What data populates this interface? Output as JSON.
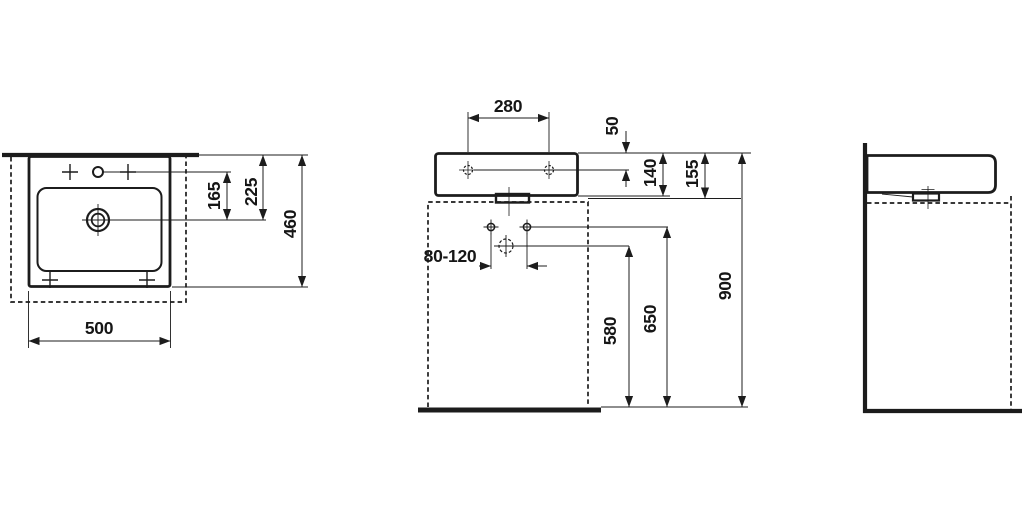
{
  "drawing": {
    "kind": "washbasin-dimension-drawing",
    "dims": {
      "tv_tap_to_drain": "165",
      "tv_wall_to_drain": "225",
      "tv_depth": "460",
      "tv_width": "500",
      "fv_hole_spacing": "280",
      "fv_top_to_fixing": "50",
      "fv_body_height": "140",
      "fv_total_height": "155",
      "fv_supply_spacing": "80-120",
      "fv_drain_height": "580",
      "fv_supply_height": "650",
      "fv_rim_height": "900"
    }
  }
}
